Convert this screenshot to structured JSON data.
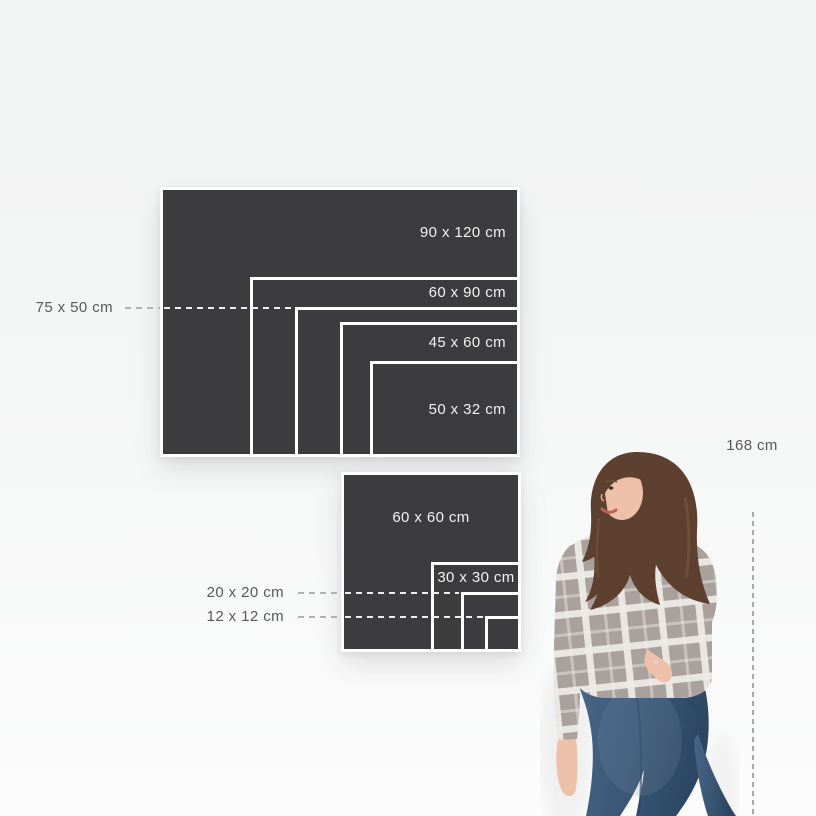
{
  "scene": {
    "width": 816,
    "height": 816,
    "bg_top": "#f2f3f3",
    "bg_bottom": "#fcfcfc"
  },
  "panel": {
    "fill": "#3c3c3e",
    "border": "#ffffff",
    "inside_label_color": "#f2f1ef",
    "outside_label_color": "#59595b",
    "dash_gray": "#b1b1b2",
    "dash_white": "#efeeec"
  },
  "px_per_cm": 3,
  "groups": [
    {
      "id": "landscape-sizes",
      "anchor_right": 520,
      "anchor_bottom": 457,
      "label_align": "right",
      "sizes": [
        {
          "id": "90x120",
          "label": "90 x 120 cm",
          "w_cm": 120,
          "h_cm": 90,
          "placement": "inside"
        },
        {
          "id": "60x90",
          "label": "60 x 90 cm",
          "w_cm": 90,
          "h_cm": 60,
          "placement": "inside"
        },
        {
          "id": "75x50",
          "label": "75 x 50 cm",
          "w_cm": 75,
          "h_cm": 50,
          "placement": "outside",
          "dash_from_x": 125,
          "label_right_x": 113
        },
        {
          "id": "45x60",
          "label": "45 x 60 cm",
          "w_cm": 60,
          "h_cm": 45,
          "placement": "inside"
        },
        {
          "id": "50x32",
          "label": "50 x 32 cm",
          "w_cm": 50,
          "h_cm": 32,
          "placement": "inside"
        }
      ]
    },
    {
      "id": "square-sizes",
      "anchor_right": 521,
      "anchor_bottom": 652,
      "label_align": "center",
      "sizes": [
        {
          "id": "60x60",
          "label": "60 x 60 cm",
          "w_cm": 60,
          "h_cm": 60,
          "placement": "inside"
        },
        {
          "id": "30x30",
          "label": "30 x 30 cm",
          "w_cm": 30,
          "h_cm": 30,
          "placement": "inside"
        },
        {
          "id": "20x20",
          "label": "20 x 20 cm",
          "w_cm": 20,
          "h_cm": 20,
          "placement": "outside",
          "dash_from_x": 298,
          "label_right_x": 284
        },
        {
          "id": "12x12",
          "label": "12 x 12 cm",
          "w_cm": 12,
          "h_cm": 12,
          "placement": "outside",
          "dash_from_x": 298,
          "label_right_x": 284
        }
      ]
    }
  ],
  "person": {
    "height_label": "168 cm",
    "label_center_x": 752,
    "label_top": 437,
    "dash_x": 753,
    "dash_top": 512,
    "dash_bottom": 816,
    "dash_color": "#a9a9aa",
    "colors": {
      "hair": "#5d4030",
      "hair_light": "#7c5840",
      "skin": "#eec0a9",
      "skin_shade": "#d9a68d",
      "sweater": "#aaa19c",
      "plaid": "#efebe7",
      "jeans": "#3c5878",
      "jeans_dark": "#2b445f",
      "lips": "#b66455"
    }
  }
}
